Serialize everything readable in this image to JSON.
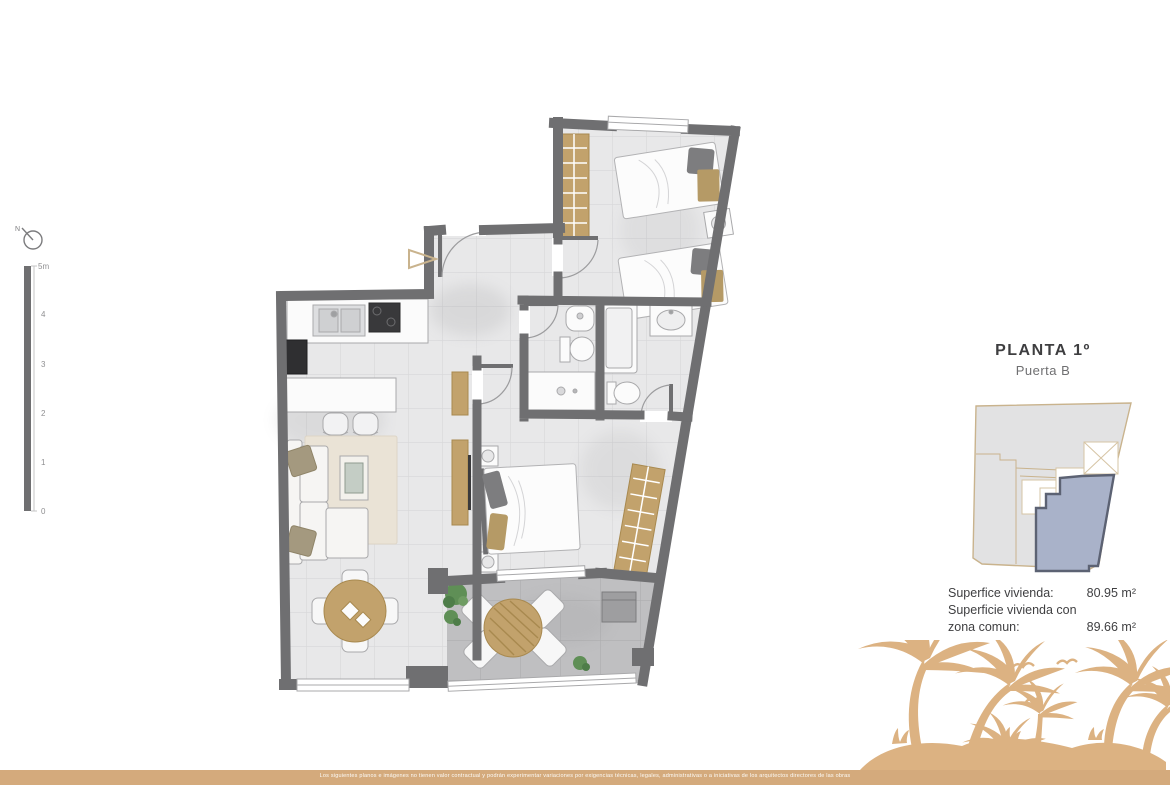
{
  "compass": {
    "label": "N"
  },
  "scale_bar": {
    "labels": [
      "5m",
      "4",
      "3",
      "2",
      "1",
      "0"
    ]
  },
  "unit_info": {
    "title": "PLANTA 1º",
    "subtitle": "Puerta B"
  },
  "areas": {
    "row1_label": "Superfice vivienda:",
    "row1_value": "80.95 m²",
    "row2_label": "Superficie vivienda con zona comun:",
    "row2_value": "89.66 m²"
  },
  "disclaimer": "Los siguientes planos e imágenes no tienen valor contractual y podrán experimentar variaciones por exigencias técnicas, legales, administrativas o a iniciativas de los arquitectos directores de las obras",
  "colors": {
    "wall": "#6f6f71",
    "accent_tan": "#d4aa7c",
    "wood": "#c2a26c",
    "keyplan_highlight": "#a9b2c9",
    "terrace_floor": "#bfbfc1"
  }
}
